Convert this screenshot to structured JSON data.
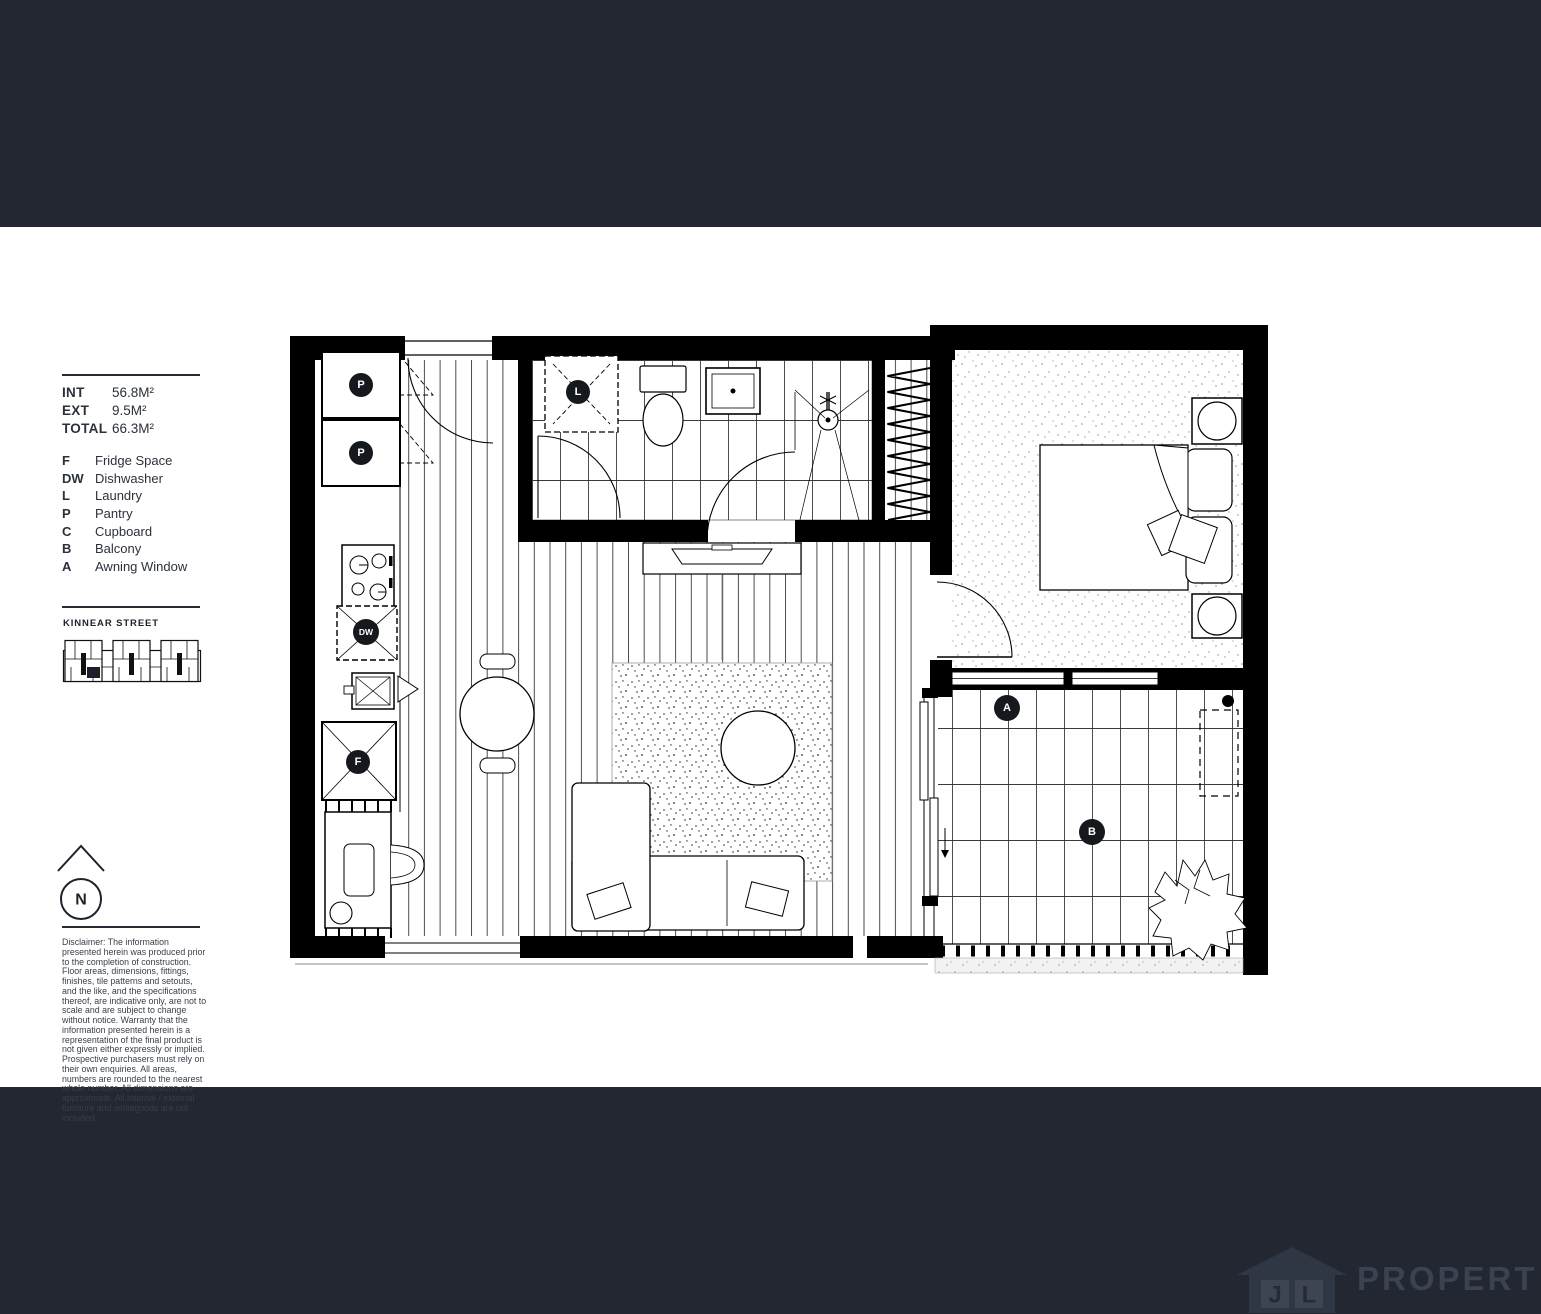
{
  "sidebar": {
    "areas": [
      {
        "label": "INT",
        "value": "56.8M²"
      },
      {
        "label": "EXT",
        "value": "9.5M²"
      },
      {
        "label": "TOTAL",
        "value": "66.3M²"
      }
    ],
    "legend": [
      {
        "key": "F",
        "label": "Fridge Space"
      },
      {
        "key": "DW",
        "label": "Dishwasher"
      },
      {
        "key": "L",
        "label": "Laundry"
      },
      {
        "key": "P",
        "label": "Pantry"
      },
      {
        "key": "C",
        "label": "Cupboard"
      },
      {
        "key": "B",
        "label": "Balcony"
      },
      {
        "key": "A",
        "label": "Awning Window"
      }
    ],
    "street_label": "KINNEAR STREET",
    "compass": "N",
    "disclaimer": "Disclaimer: The information presented herein was produced prior to the completion of construction. Floor areas, dimensions, fittings, finishes, tile patterns and setouts, and the like, and the specifications thereof, are indicative only, are not to scale and are subject to change without notice. Warranty that the information presented herein is a representation of the final product is not given either expressly or implied. Prospective purchasers must rely on their own enquiries. All areas, numbers are rounded to the nearest whole number. All dimensions are approximate. All internal / external furniture and whitegoods are not included."
  },
  "plan": {
    "markers": {
      "pantry_top": "P",
      "pantry_bottom": "P",
      "laundry": "L",
      "dishwasher": "DW",
      "fridge": "F",
      "awning": "A",
      "balcony": "B"
    }
  },
  "footer": {
    "logo_j": "J",
    "logo_l": "L",
    "logo_text": "PROPERTY"
  },
  "colors": {
    "band": "#222731",
    "logo_house": "#303744",
    "logo_box": "#3d4554",
    "logo_letter": "#242a36",
    "logo_wordmark": "#3b4352",
    "wall": "#000000"
  }
}
